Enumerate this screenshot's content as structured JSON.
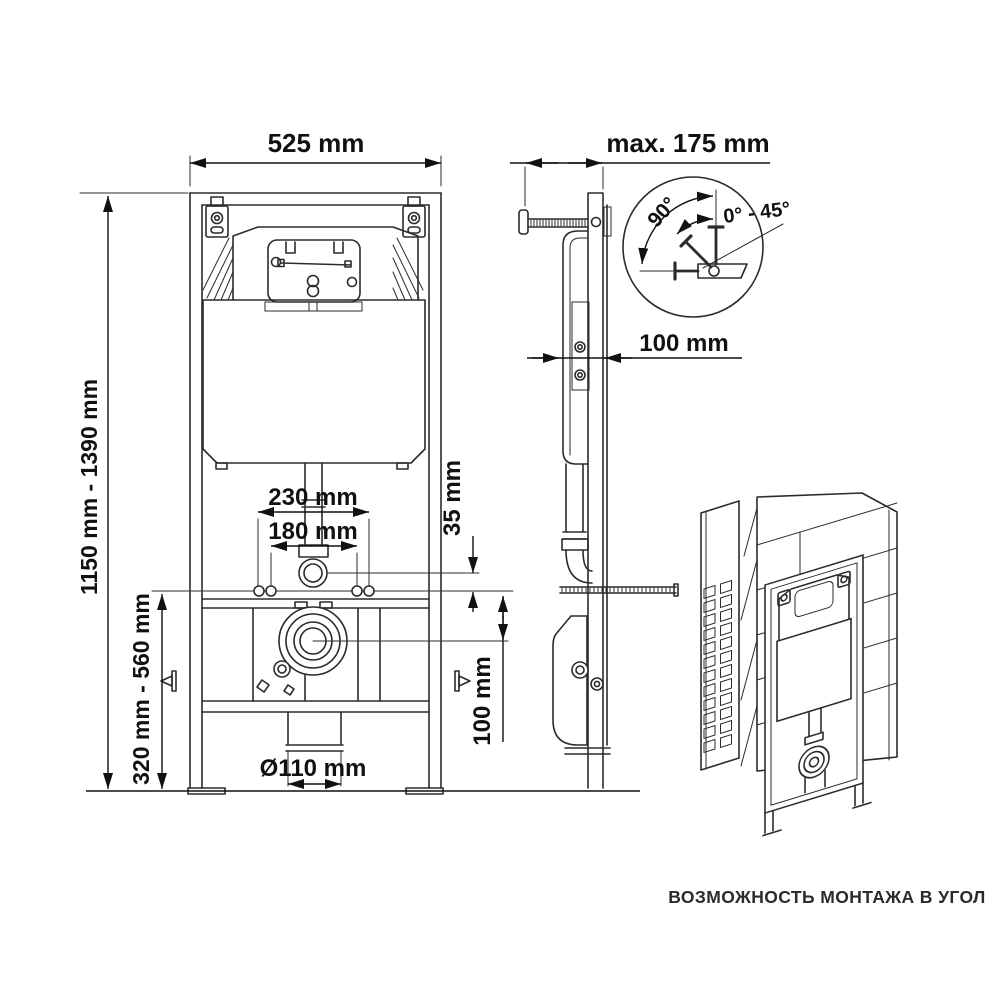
{
  "front_view": {
    "dim_width": "525 mm",
    "dim_height_range": "1150 mm - 1390 mm",
    "dim_outlet_range": "320 mm - 560 mm",
    "dim_fix_outer": "230 mm",
    "dim_fix_inner": "180 mm",
    "dim_offset": "35 mm",
    "dim_drain_drop": "100 mm",
    "dim_drain_diameter": "Ø110 mm"
  },
  "side_view": {
    "dim_depth_max": "max. 175 mm",
    "dim_frame_depth": "100 mm"
  },
  "angle_detail": {
    "angle_full": "90°",
    "angle_range": "0° - 45°"
  },
  "corner_view": {
    "caption": "ВОЗМОЖНОСТЬ МОНТАЖА В УГОЛ"
  },
  "colors": {
    "line": "#2b2b2b",
    "text": "#111111",
    "background": "#ffffff"
  }
}
